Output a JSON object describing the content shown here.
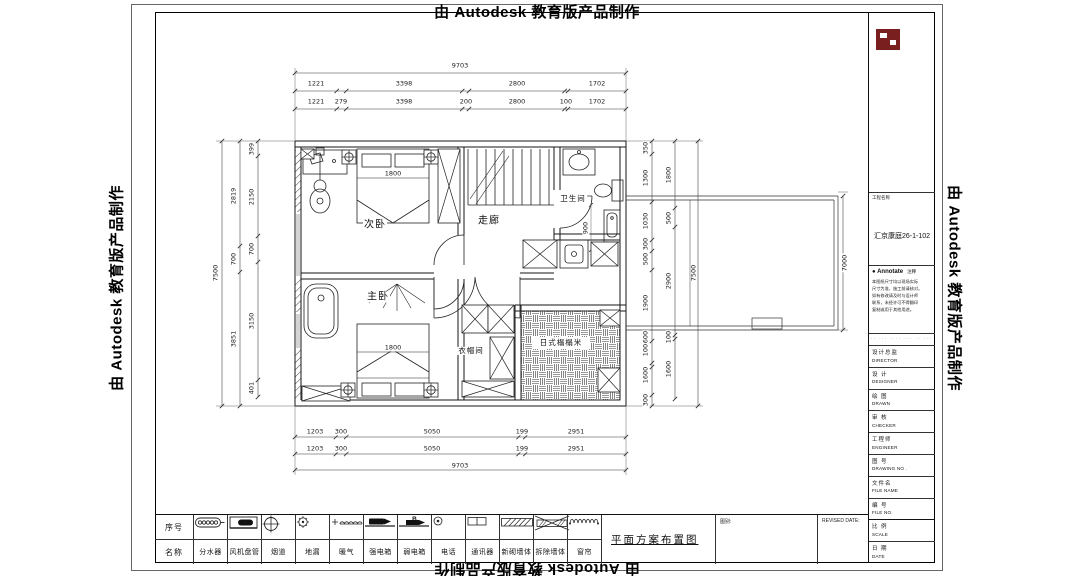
{
  "stamp": {
    "text": "由 Autodesk 教育版产品制作"
  },
  "plan": {
    "rooms": [
      {
        "id": "room-label-secondary-bedroom",
        "label": "次卧",
        "x": 375,
        "y": 225,
        "s": 10
      },
      {
        "id": "room-label-corridor",
        "label": "走廊",
        "x": 489,
        "y": 221,
        "s": 10
      },
      {
        "id": "room-label-bathroom",
        "label": "卫生间",
        "x": 573,
        "y": 199,
        "s": 7.5
      },
      {
        "id": "room-label-master-bedroom",
        "label": "主卧",
        "x": 378,
        "y": 297,
        "s": 10
      },
      {
        "id": "room-label-cloakroom",
        "label": "衣帽间",
        "x": 471,
        "y": 351,
        "s": 7.5
      },
      {
        "id": "room-label-tatami",
        "label": "日式榻榻米",
        "x": 561,
        "y": 343,
        "s": 7.5
      }
    ]
  },
  "dimensions": [
    {
      "t": "9703",
      "x": 460,
      "y": 66
    },
    {
      "t": "1221",
      "x": 316,
      "y": 84
    },
    {
      "t": "3398",
      "x": 404,
      "y": 84
    },
    {
      "t": "2800",
      "x": 517,
      "y": 84
    },
    {
      "t": "1702",
      "x": 597,
      "y": 84
    },
    {
      "t": "1221",
      "x": 316,
      "y": 102
    },
    {
      "t": "279",
      "x": 341,
      "y": 102
    },
    {
      "t": "3398",
      "x": 404,
      "y": 102
    },
    {
      "t": "200",
      "x": 466,
      "y": 102
    },
    {
      "t": "2800",
      "x": 517,
      "y": 102
    },
    {
      "t": "100",
      "x": 566,
      "y": 102
    },
    {
      "t": "1702",
      "x": 597,
      "y": 102
    },
    {
      "t": "1203",
      "x": 315,
      "y": 432
    },
    {
      "t": "300",
      "x": 341,
      "y": 432
    },
    {
      "t": "5050",
      "x": 432,
      "y": 432
    },
    {
      "t": "199",
      "x": 522,
      "y": 432
    },
    {
      "t": "2951",
      "x": 576,
      "y": 432
    },
    {
      "t": "1203",
      "x": 315,
      "y": 449
    },
    {
      "t": "300",
      "x": 341,
      "y": 449
    },
    {
      "t": "5050",
      "x": 432,
      "y": 449
    },
    {
      "t": "199",
      "x": 522,
      "y": 449
    },
    {
      "t": "2951",
      "x": 576,
      "y": 449
    },
    {
      "t": "9703",
      "x": 460,
      "y": 466
    },
    {
      "t": "7500",
      "x": 216,
      "y": 273,
      "r": 1
    },
    {
      "t": "2819",
      "x": 234,
      "y": 196,
      "r": 1
    },
    {
      "t": "700",
      "x": 234,
      "y": 259,
      "r": 1
    },
    {
      "t": "3851",
      "x": 234,
      "y": 339,
      "r": 1
    },
    {
      "t": "399",
      "x": 252,
      "y": 149,
      "r": 1
    },
    {
      "t": "2150",
      "x": 252,
      "y": 197,
      "r": 1
    },
    {
      "t": "700",
      "x": 252,
      "y": 249,
      "r": 1
    },
    {
      "t": "3150",
      "x": 252,
      "y": 321,
      "r": 1
    },
    {
      "t": "401",
      "x": 252,
      "y": 388,
      "r": 1
    },
    {
      "t": "350",
      "x": 646,
      "y": 148,
      "r": 1
    },
    {
      "t": "1300",
      "x": 646,
      "y": 178,
      "r": 1
    },
    {
      "t": "1030",
      "x": 646,
      "y": 221,
      "r": 1
    },
    {
      "t": "300",
      "x": 646,
      "y": 244,
      "r": 1
    },
    {
      "t": "500",
      "x": 646,
      "y": 259,
      "r": 1
    },
    {
      "t": "1900",
      "x": 646,
      "y": 303,
      "r": 1
    },
    {
      "t": "600",
      "x": 646,
      "y": 337,
      "r": 1
    },
    {
      "t": "100",
      "x": 646,
      "y": 350,
      "r": 1
    },
    {
      "t": "1600",
      "x": 646,
      "y": 375,
      "r": 1
    },
    {
      "t": "300",
      "x": 646,
      "y": 400,
      "r": 1
    },
    {
      "t": "1800",
      "x": 669,
      "y": 175,
      "r": 1
    },
    {
      "t": "500",
      "x": 669,
      "y": 218,
      "r": 1
    },
    {
      "t": "2900",
      "x": 669,
      "y": 281,
      "r": 1
    },
    {
      "t": "100",
      "x": 669,
      "y": 337,
      "r": 1
    },
    {
      "t": "1600",
      "x": 669,
      "y": 369,
      "r": 1
    },
    {
      "t": "7500",
      "x": 694,
      "y": 273,
      "r": 1
    },
    {
      "t": "7000",
      "x": 845,
      "y": 263,
      "r": 1
    },
    {
      "t": "1800",
      "x": 393,
      "y": 174
    },
    {
      "t": "1800",
      "x": 393,
      "y": 348
    },
    {
      "t": "900",
      "x": 586,
      "y": 228,
      "r": 1
    }
  ],
  "title_block": {
    "project_label": "工程名称",
    "project_name": "汇京康庭26-1-102",
    "annotate_bullet": "●",
    "annotate_title": "Annotate",
    "annotate_suffix": "注释",
    "notes": [
      "本图纸尺寸均以现场实际",
      "尺寸为准，施工前请核对。",
      "如有修改请及时与设计师",
      "联系，未经许可不得翻印",
      "复制或用于其他用途。"
    ],
    "micro_text": "·· ··· ···· ··· ·· ··· ···· ···",
    "rows": [
      {
        "zh": "设计总监",
        "en": "DIRECTOR"
      },
      {
        "zh": "设 计",
        "en": "DESIGNER"
      },
      {
        "zh": "绘 图",
        "en": "DRAWN"
      },
      {
        "zh": "审 核",
        "en": "CHECKER"
      },
      {
        "zh": "工程师",
        "en": "ENGINEER"
      },
      {
        "zh": "图 号",
        "en": "DRAWING NO ."
      },
      {
        "zh": "文件名",
        "en": "FILE NAME"
      },
      {
        "zh": "编 号",
        "en": "FILE NO."
      },
      {
        "zh": "比 例",
        "en": "SCALE"
      },
      {
        "zh": "日 期",
        "en": "DATE"
      }
    ]
  },
  "legend": {
    "header_top": "序号",
    "header_bottom": "名称",
    "items": [
      {
        "name": "分水器",
        "icon": "manifold"
      },
      {
        "name": "风机盘管",
        "icon": "fan-coil"
      },
      {
        "name": "烟道",
        "icon": "flue"
      },
      {
        "name": "地漏",
        "icon": "floor-drain"
      },
      {
        "name": "暖气",
        "icon": "radiator"
      },
      {
        "name": "强电箱",
        "icon": "power-box"
      },
      {
        "name": "弱电箱",
        "icon": "weak-box",
        "letter": "B"
      },
      {
        "name": "电话",
        "icon": "phone"
      },
      {
        "name": "通讯器",
        "icon": "intercom"
      },
      {
        "name": "新砌墙体",
        "icon": "new-wall"
      },
      {
        "name": "拆除墙体",
        "icon": "demolish-wall"
      },
      {
        "name": "窗帘",
        "icon": "curtain"
      }
    ],
    "drawing_title": "平面方案布置图",
    "cell_a_label": "图别:",
    "cell_b_label": "REVISED DATE:"
  }
}
